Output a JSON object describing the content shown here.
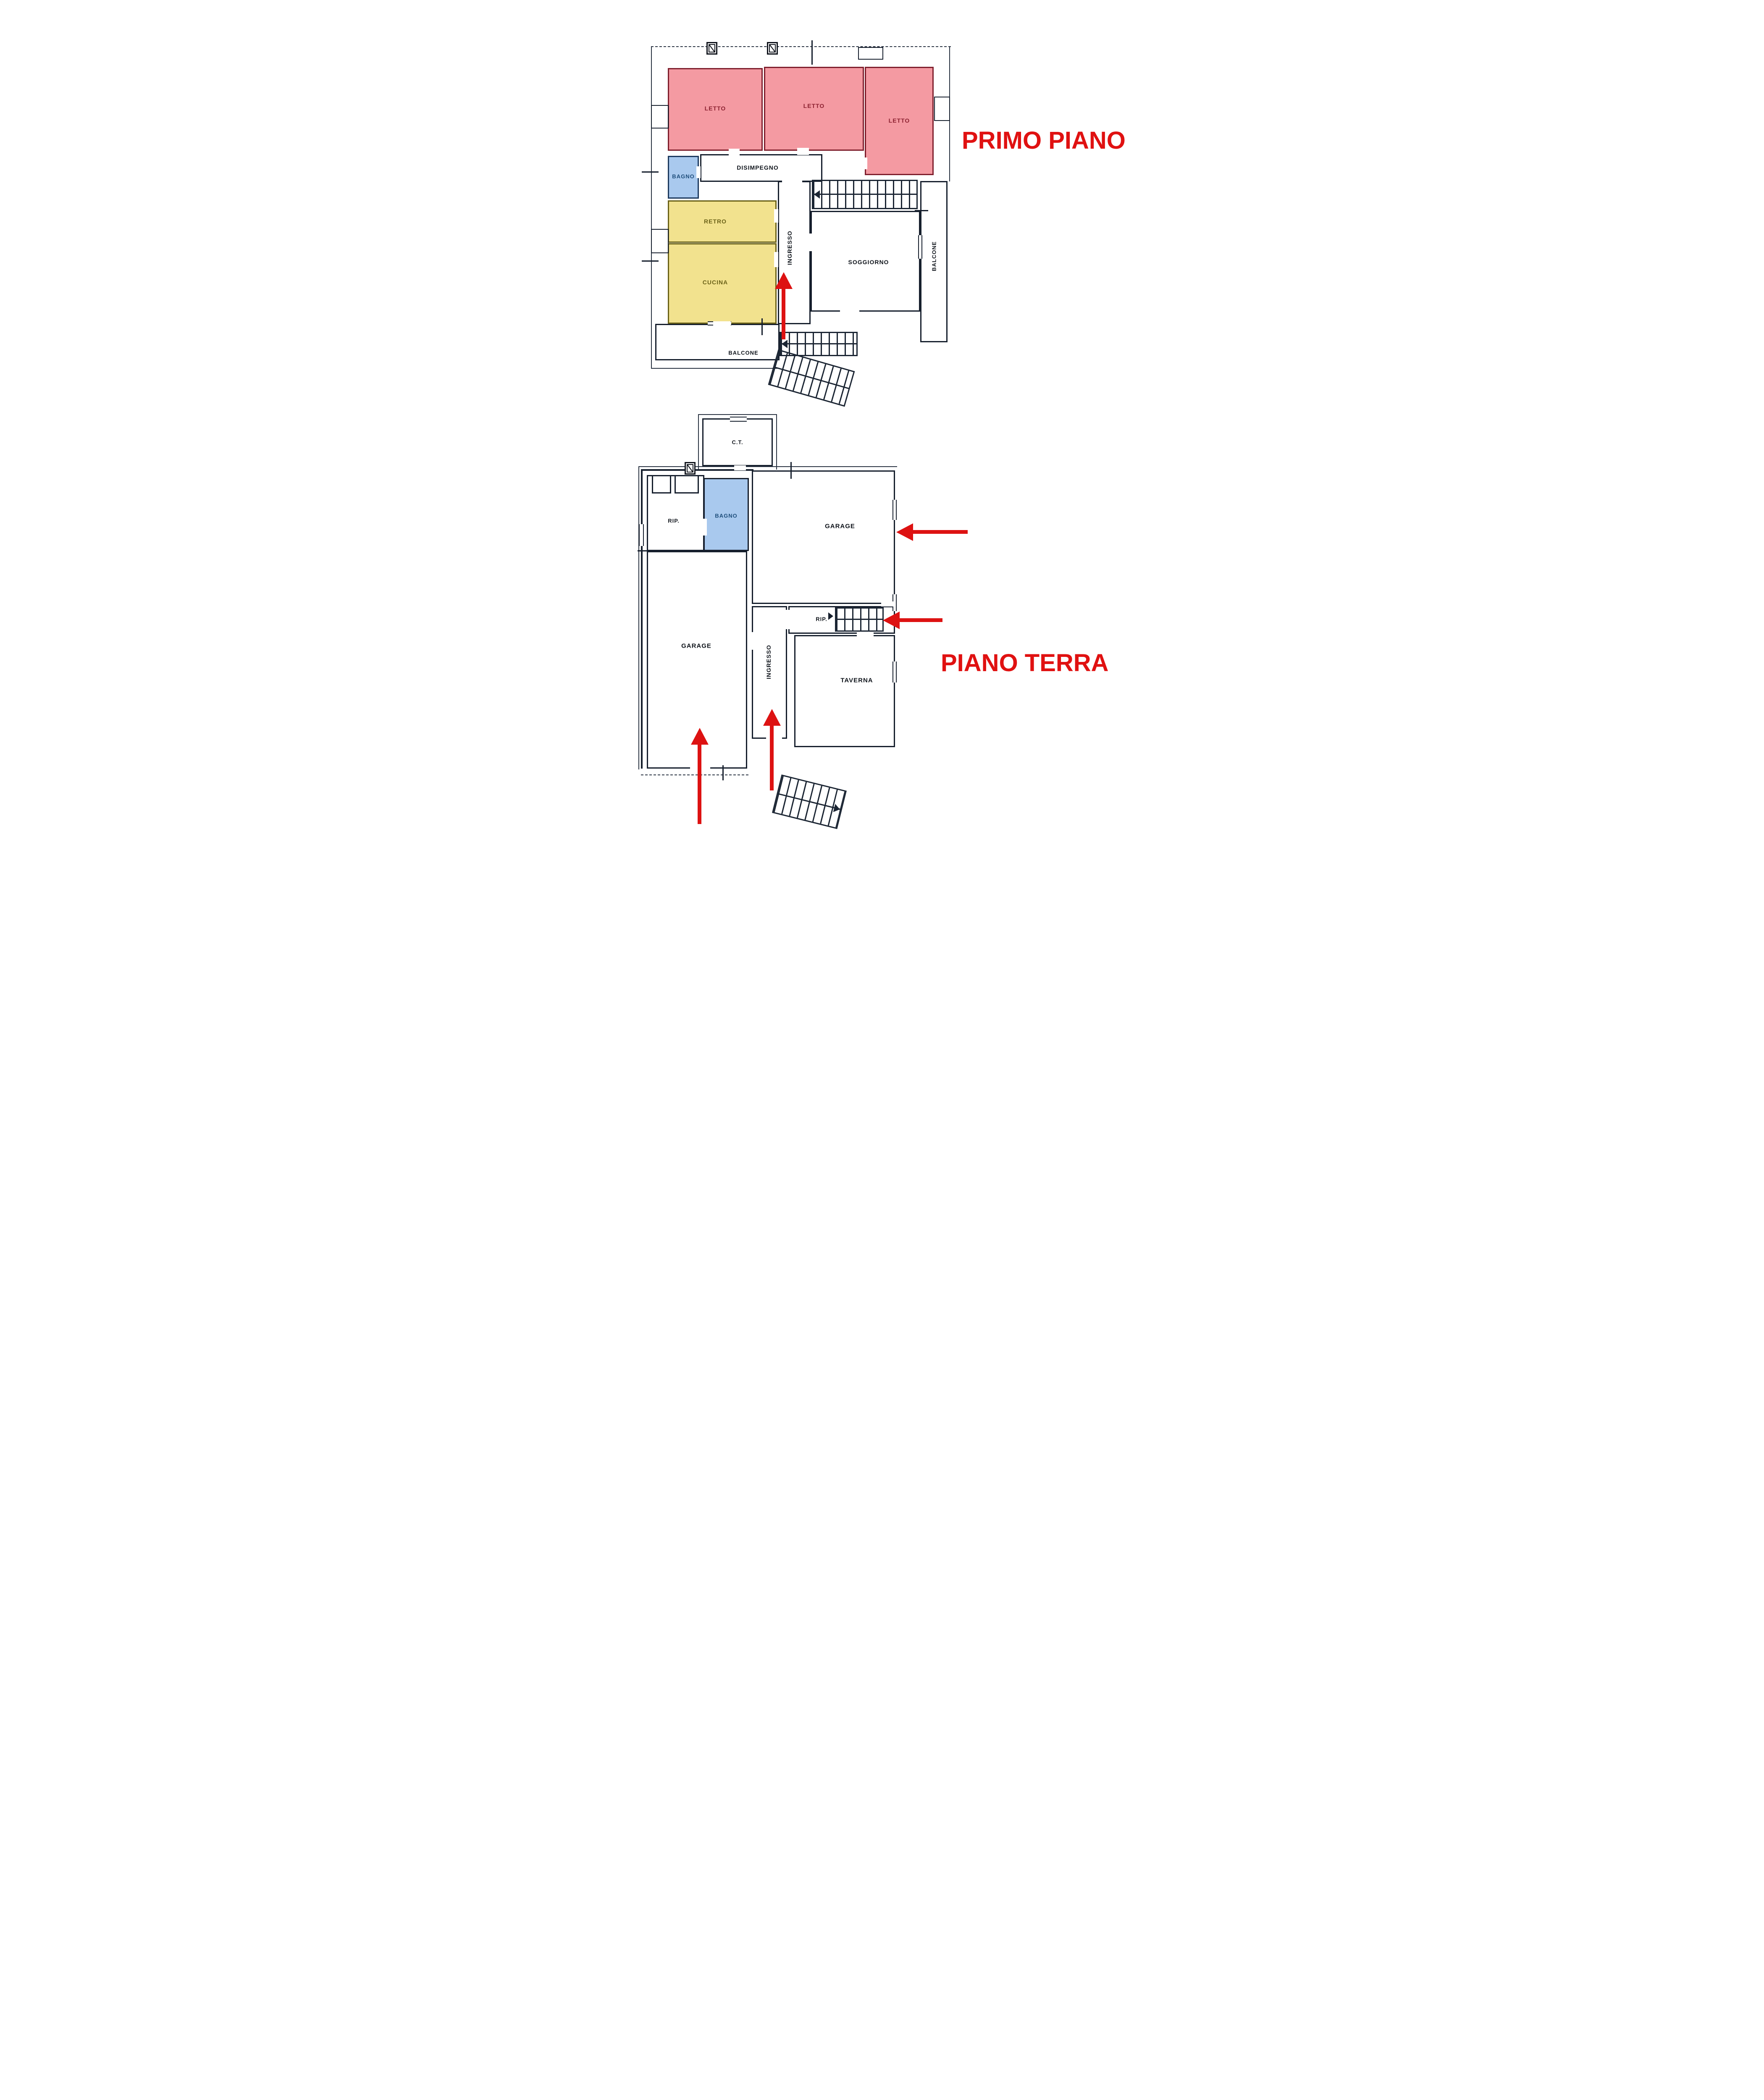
{
  "first_floor": {
    "title": "PRIMO PIANO",
    "rooms": {
      "letto_1": "LETTO",
      "letto_2": "LETTO",
      "letto_3": "LETTO",
      "bagno": "BAGNO",
      "disimpegno": "DISIMPEGNO",
      "retro": "RETRO",
      "cucina": "CUCINA",
      "ingresso": "INGRESSO",
      "soggiorno": "SOGGIORNO",
      "balcone_right": "BALCONE",
      "balcone_bottom": "BALCONE"
    }
  },
  "ground_floor": {
    "title": "PIANO TERRA",
    "rooms": {
      "ct": "C.T.",
      "rip_1": "RIP.",
      "bagno": "BAGNO",
      "garage_top": "GARAGE",
      "garage_left": "GARAGE",
      "ingresso": "INGRESSO",
      "rip_2": "RIP.",
      "taverna": "TAVERNA"
    }
  },
  "colors": {
    "bedroom_fill": "#f49aa2",
    "bedroom_line": "#7f1f2d",
    "bath_fill": "#a9c9ee",
    "bath_text": "#1d4d7b",
    "kitchen_fill": "#f2e28e",
    "kitchen_line": "#6b6218",
    "wall": "#161f2d",
    "arrow_red": "#dd1212",
    "title_red": "#e01111"
  },
  "annotations": {
    "arrows": [
      {
        "floor": "primo_piano",
        "at": "ingresso",
        "direction": "up"
      },
      {
        "floor": "piano_terra",
        "at": "garage_top",
        "direction": "left"
      },
      {
        "floor": "piano_terra",
        "at": "rip_stairs",
        "direction": "left"
      },
      {
        "floor": "piano_terra",
        "at": "ingresso",
        "direction": "up"
      },
      {
        "floor": "piano_terra",
        "at": "garage_left",
        "direction": "up"
      }
    ]
  }
}
